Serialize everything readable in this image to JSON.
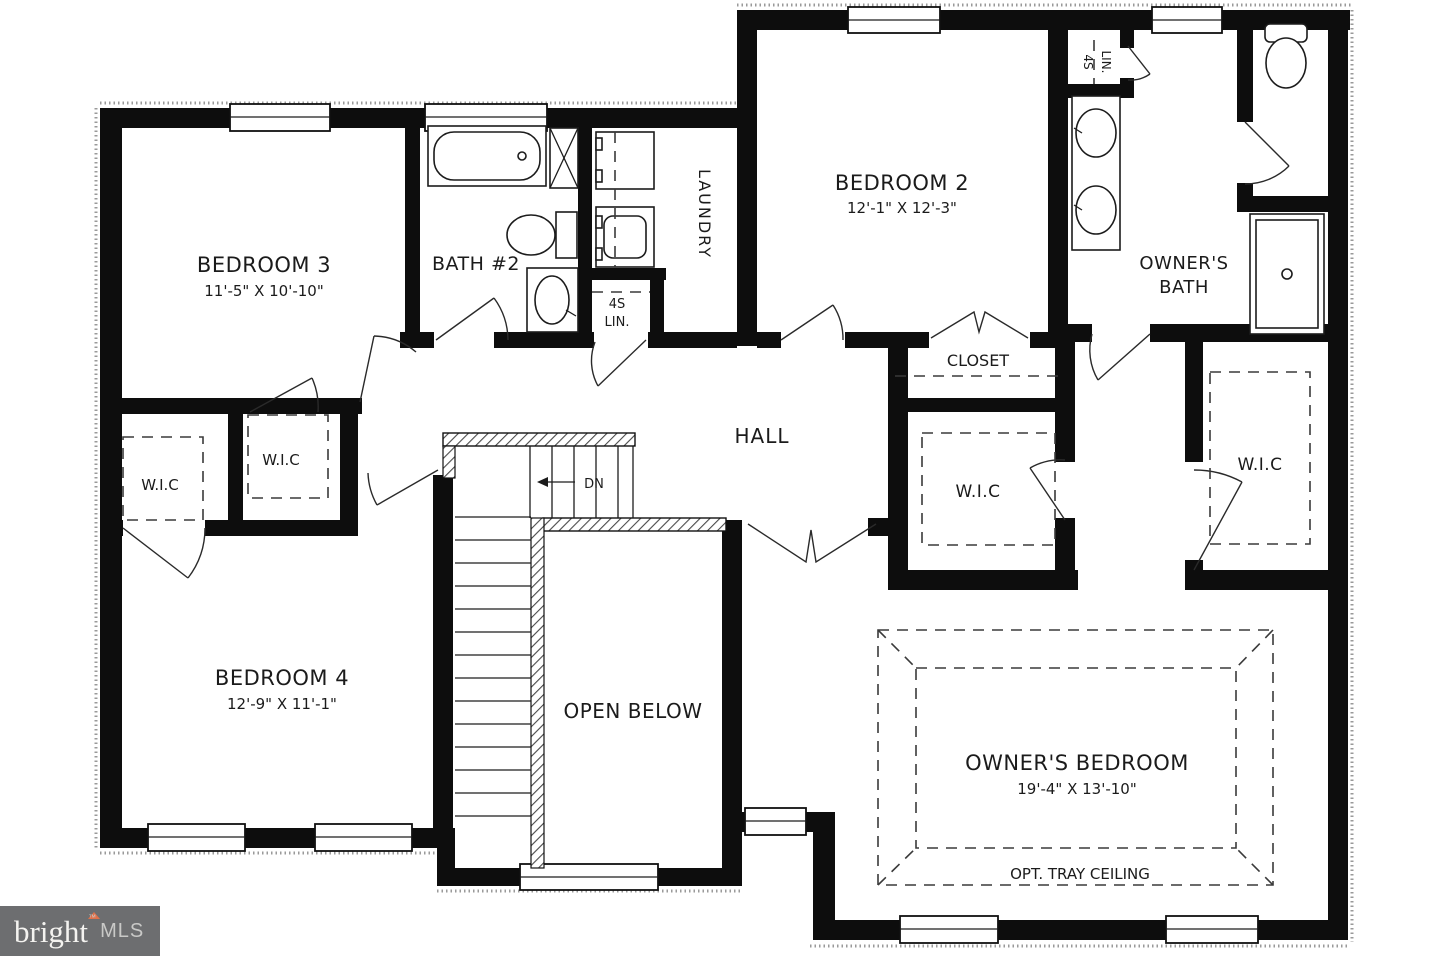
{
  "plan": {
    "ink_color": "#0d0d0d",
    "rooms": {
      "bedroom3": {
        "name": "BEDROOM 3",
        "dims": "11'-5\" X 10'-10\""
      },
      "bath2": {
        "name": "BATH #2"
      },
      "laundry": {
        "name": "LAUNDRY"
      },
      "linen_hall": {
        "line1": "4S",
        "line2": "LIN."
      },
      "bedroom2": {
        "name": "BEDROOM 2",
        "dims": "12'-1\" X 12'-3\""
      },
      "linen_owner": {
        "line1": "4S",
        "line2": "LIN."
      },
      "owners_bath": {
        "line1": "OWNER'S",
        "line2": "BATH"
      },
      "closet": {
        "name": "CLOSET"
      },
      "hall": {
        "name": "HALL"
      },
      "wic": {
        "name": "W.I.C"
      },
      "bedroom4": {
        "name": "BEDROOM 4",
        "dims": "12'-9\" X 11'-1\""
      },
      "open_below": {
        "name": "OPEN BELOW"
      },
      "owners_bedroom": {
        "name": "OWNER'S BEDROOM",
        "dims": "19'-4\" X 13'-10\"",
        "ceiling_note": "OPT. TRAY CEILING"
      }
    },
    "stairs": {
      "down_label": "DN"
    }
  },
  "logo": {
    "brand": "bright",
    "tm": "™",
    "suffix": "MLS",
    "background": "#6d6e70",
    "brand_color": "#f4f3f0",
    "suffix_color": "#c9c9c7",
    "accent": "#e0714a"
  }
}
